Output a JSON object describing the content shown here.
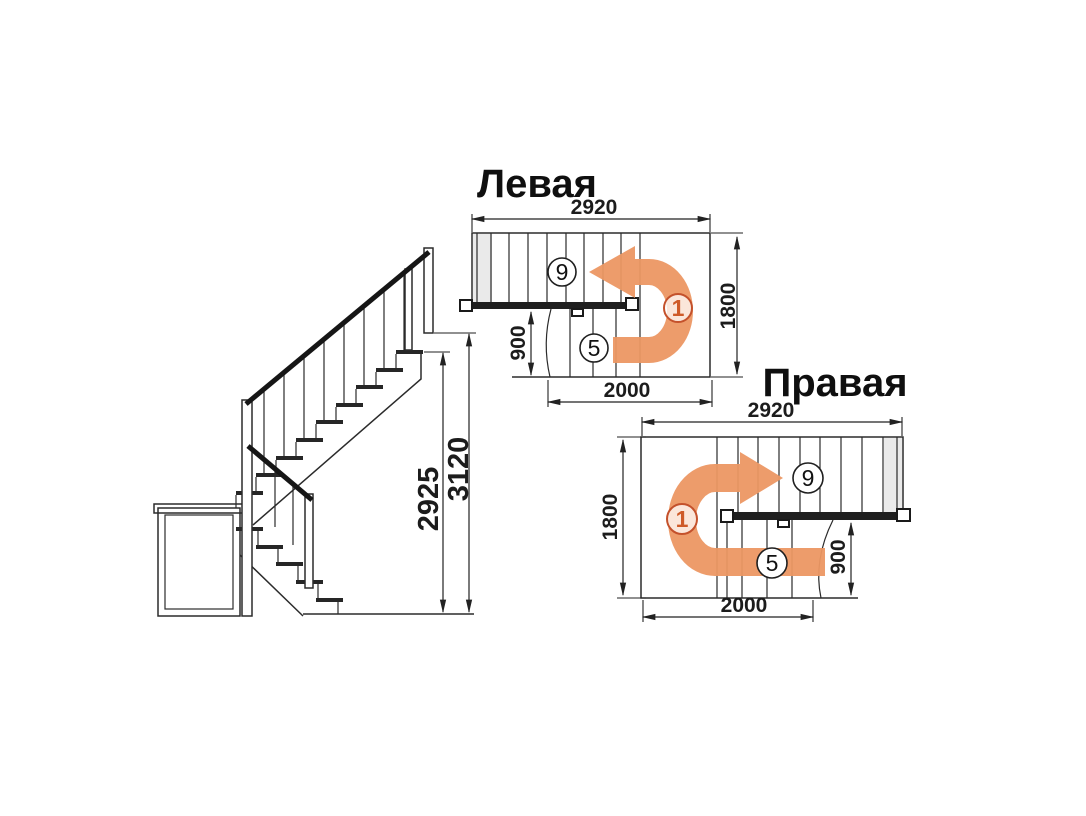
{
  "titles": {
    "left": "Левая",
    "right": "Правая"
  },
  "colors": {
    "arrow_orange": "#EC9763",
    "accent_orange": "#CE5A28",
    "line": "#2B2B2B"
  },
  "elevation": {
    "dim_height_to_landing": "2925",
    "dim_height_total": "3120"
  },
  "plan_left": {
    "dim_total_length": "2920",
    "dim_total_width": "1800",
    "dim_flight_width": "900",
    "dim_lower_length": "2000",
    "upper_steps_count": "9",
    "lower_steps_count": "5",
    "start_step": "1"
  },
  "plan_right": {
    "dim_total_length": "2920",
    "dim_total_width": "1800",
    "dim_flight_width": "900",
    "dim_lower_length": "2000",
    "upper_steps_count": "9",
    "lower_steps_count": "5",
    "start_step": "1"
  }
}
